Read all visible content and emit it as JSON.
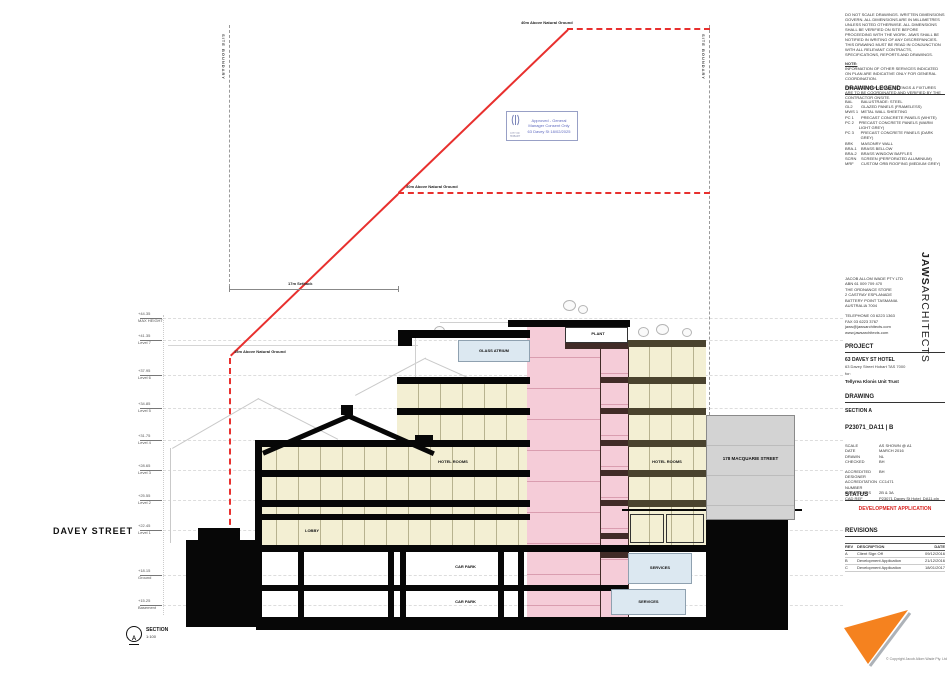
{
  "drawing_area": {
    "street": "DAVEY STREET",
    "neighbour": "178 MACQUARIE STREET",
    "boundary_label": "SITE BOUNDARY",
    "envelope": {
      "l40": "40m Above Natural Ground",
      "l30": "30m Above Natural Ground",
      "l15": "15m Above Natural Ground",
      "setback": "17m Setback"
    },
    "rooms": {
      "glass_atrium": "GLASS ATRIUM",
      "plant": "PLANT",
      "hotel_rooms": "HOTEL ROOMS",
      "lobby": "LOBBY",
      "car_park": "CAR PARK",
      "services": "SERVICES"
    },
    "stamp": {
      "line1": "Approved - General",
      "line2": "Manager Consent Only",
      "line3": "63 Davey St 18/02/2025",
      "org": "CITY OF HOBART"
    },
    "section_marker": {
      "letter": "A",
      "label": "SECTION",
      "scale": "1:100"
    },
    "levels": [
      {
        "rl": "+44.35",
        "name": "MAX HEIGHT"
      },
      {
        "rl": "+41.35",
        "name": "Level 7"
      },
      {
        "rl": "+37.95",
        "name": "Level 6"
      },
      {
        "rl": "+34.85",
        "name": "Level 5"
      },
      {
        "rl": "+31.75",
        "name": "Level 4"
      },
      {
        "rl": "+28.65",
        "name": "Level 3"
      },
      {
        "rl": "+25.55",
        "name": "Level 2"
      },
      {
        "rl": "+22.45",
        "name": "Level 1"
      },
      {
        "rl": "+18.15",
        "name": "Ground"
      },
      {
        "rl": "+15.25",
        "name": "Basement"
      }
    ]
  },
  "titleblock": {
    "notes_para1": "DO NOT SCALE DRAWINGS. WRITTEN DIMENSIONS GOVERN. ALL DIMENSIONS ARE IN MILLIMETRES UNLESS NOTED OTHERWISE. ALL DIMENSIONS SHALL BE VERIFIED ON SITE BEFORE PROCEEDING WITH THE WORK. JAWS SHALL BE NOTIFIED IN WRITING OF ANY DISCREPANCIES. THIS DRAWING MUST BE READ IN CONJUNCTION WITH ALL RELEVANT CONTRACTS, SPECIFICATIONS, REPORTS AND DRAWINGS.",
    "note_label": "NOTE:",
    "notes_para2": "INFORMATION OF OTHER SERVICES INDICATED ON PLAN ARE INDICATIVE ONLY FOR GENERAL COORDINATION.",
    "notes_para3": "FINAL LOCATION OF ALL FITTINGS & FIXTURES ARE TO BE COORDINATED AND VERIFIED BY THE CONTRACTOR ONSITE.",
    "legend": {
      "title": "DRAWING LEGEND",
      "items": [
        {
          "code": "BAL",
          "desc": "BALUSTRADE: STEEL"
        },
        {
          "code": "GL2",
          "desc": "GLAZED PANELS (FRAMELESS)"
        },
        {
          "code": "MWS 1",
          "desc": "METAL WALL SHEETING"
        },
        {
          "code": "PC 1",
          "desc": "PRECAST CONCRETE PANELS (WHITE)"
        },
        {
          "code": "PC 2",
          "desc": "PRECAST CONCRETE PANELS (WARM LIGHT GREY)"
        },
        {
          "code": "PC 3",
          "desc": "PRECAST CONCRETE PANELS (DARK GREY)"
        },
        {
          "code": "BRK",
          "desc": "MASONRY WALL"
        },
        {
          "code": "BRA-1",
          "desc": "BRASS BELLOW"
        },
        {
          "code": "BRA-2",
          "desc": "BRASS WINDOW BAFFLES"
        },
        {
          "code": "SCRN",
          "desc": "SCREEN (PERFORATED ALUMINIUM)"
        },
        {
          "code": "MRF",
          "desc": "CUSTOM ORB ROOFING (MEDIUM GREY)"
        }
      ]
    },
    "firm": {
      "line1": "JACOB ALLOM WADE PTY LTD",
      "line2": "ABN 61 009 709 470",
      "line3": "THE ORDNANCE STORE",
      "line4": "2 CASTRAY ESPLANADE",
      "line5": "BATTERY POINT TASMANIA",
      "line6": "AUSTRALIA 7004",
      "tel": "TELEPHONE 03 6223 1363",
      "fax": "FAX 03 6223 3767",
      "email": "jaws@jawsarchitects.com",
      "web": "www.jawsarchitects.com"
    },
    "brand": {
      "bold": "JAWS",
      "rest": "ARCHITECTS"
    },
    "project": {
      "title": "PROJECT",
      "name": "63 DAVEY ST HOTEL",
      "address": "63 Davey Street Hobart TAS 7000",
      "for_label": "for:",
      "client": "Tellyrea Klonis Unit Trust"
    },
    "drawing": {
      "title": "DRAWING",
      "name": "SECTION A",
      "number": "P23071_DA11 | B"
    },
    "meta": {
      "rows": [
        {
          "label": "SCALE",
          "value": "AS SHOWN @ A1"
        },
        {
          "label": "DATE",
          "value": "MARCH 2016"
        },
        {
          "label": "DRAWN",
          "value": "NL"
        },
        {
          "label": "CHECKED",
          "value": "BH"
        },
        {
          "label": "ACCREDITED DESIGNER",
          "value": "BH"
        },
        {
          "label": "ACCREDITATION NUMBER",
          "value": "CC1471"
        },
        {
          "label": "BUILD CLASS",
          "value": "2B & 3A"
        },
        {
          "label": "CAD REF",
          "value": "P23071 Davey St Hotel_DA11.pln"
        }
      ]
    },
    "status": {
      "title": "STATUS",
      "value": "DEVELOPMENT APPLICATION"
    },
    "revisions": {
      "title": "REVISIONS",
      "col_rev": "REV",
      "col_desc": "DESCRIPTION",
      "col_date": "DATE",
      "rows": [
        {
          "rev": "A",
          "desc": "Client Sign Off",
          "date": "09/12/2016"
        },
        {
          "rev": "B",
          "desc": "Development Application",
          "date": "21/12/2016"
        },
        {
          "rev": "C",
          "desc": "Development Application",
          "date": "18/01/2017"
        }
      ]
    },
    "copyright": "© Copyright Jacob Allom Wade Pty. Ltd"
  },
  "colors": {
    "accent_red": "#e8302e",
    "status_red": "#d8231f",
    "logo_orange": "#f5821f",
    "core_pink": "#f5ccd8",
    "floor_cream": "#f3efd3",
    "services_blue": "#dce8f1",
    "neighbour_grey": "#d3d3d3"
  }
}
